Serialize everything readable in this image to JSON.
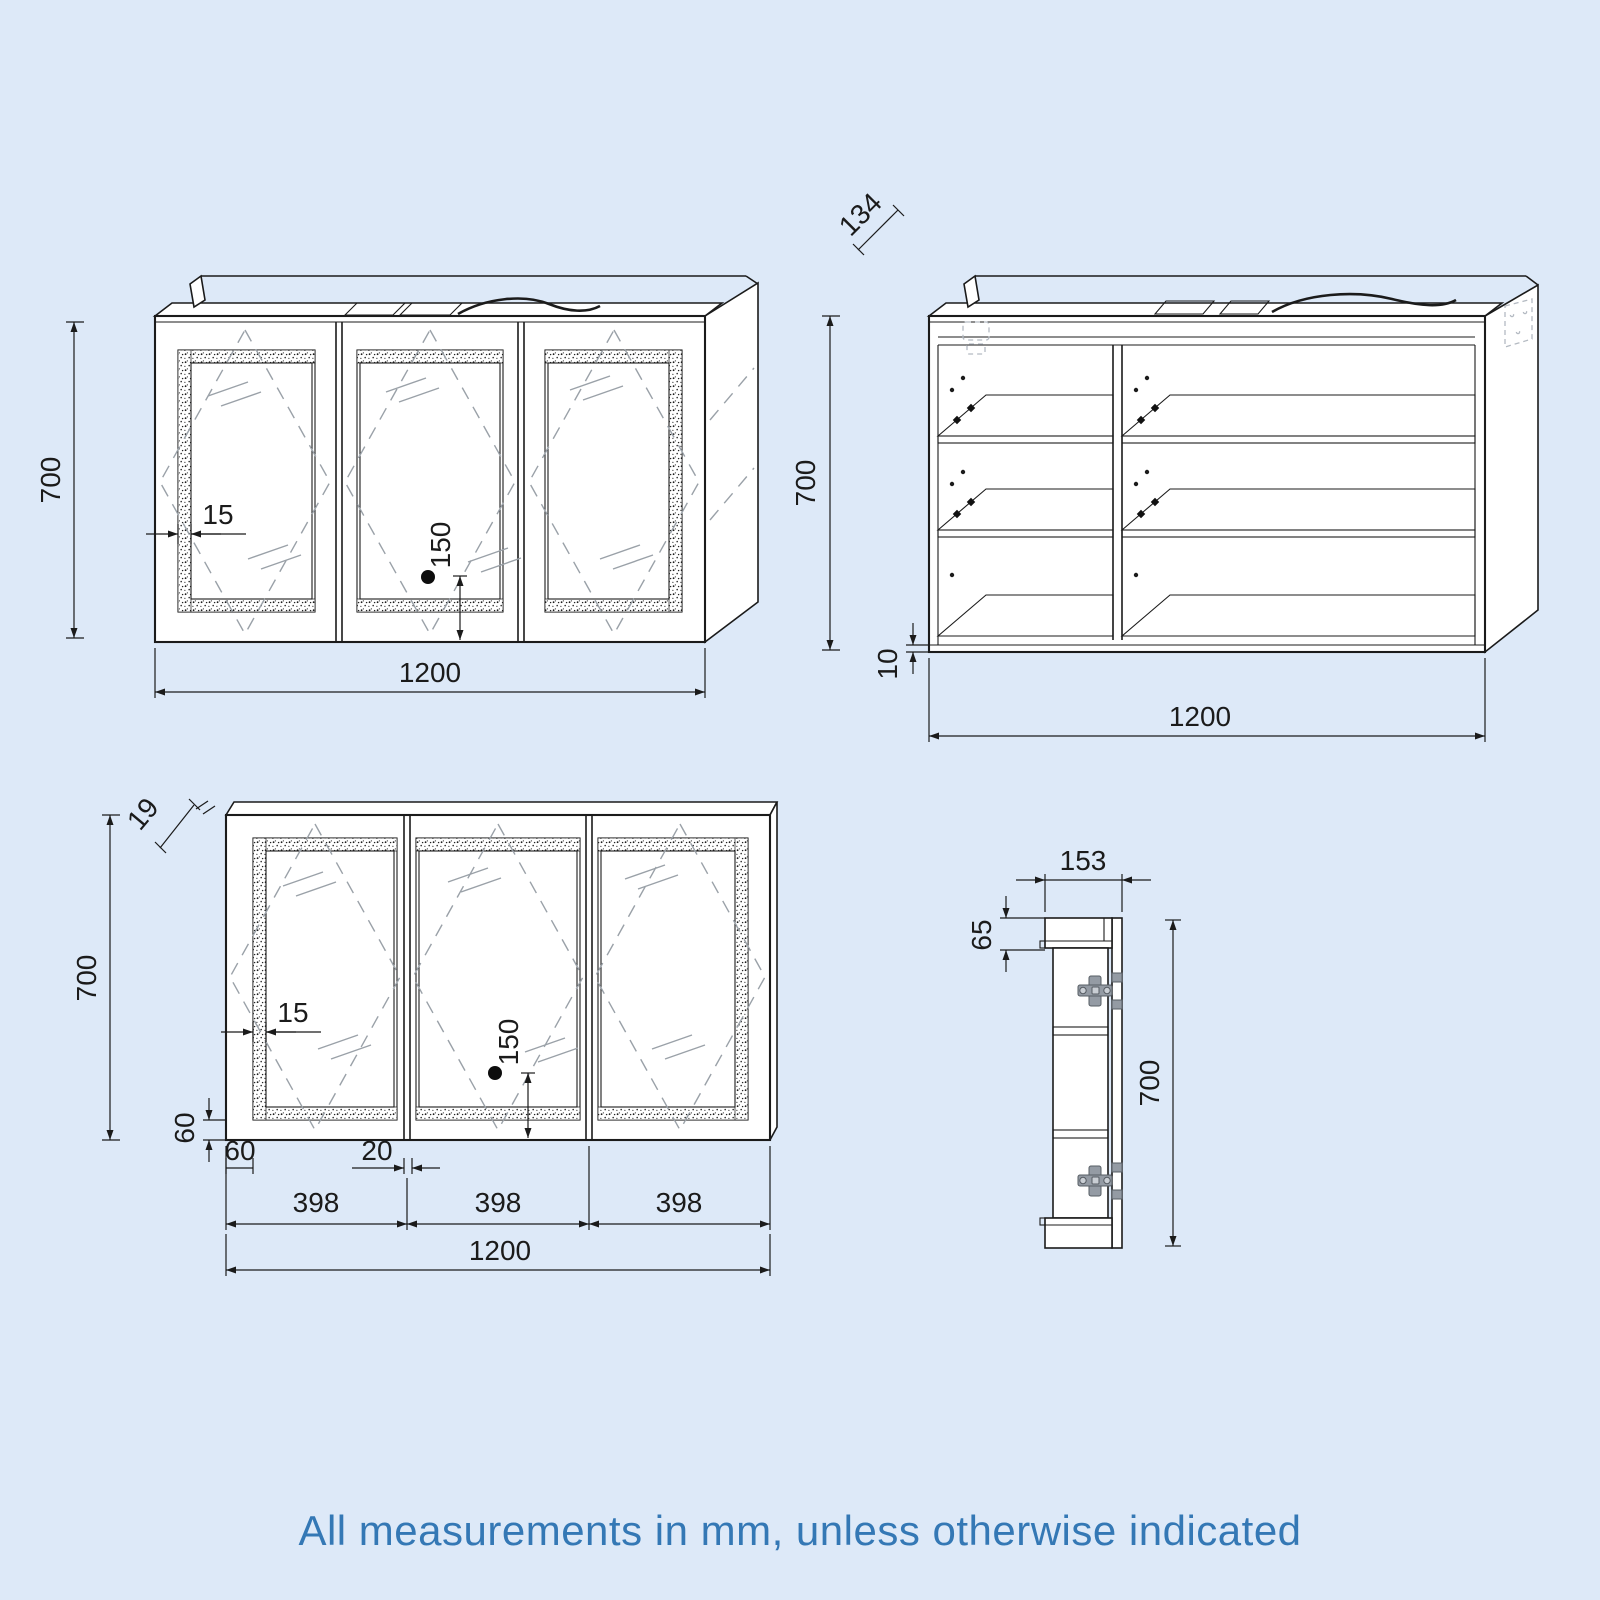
{
  "title": "Mirror cabinet technical drawing",
  "note": "All measurements in mm, unless otherwise indicated",
  "colors": {
    "background": "#dde9f8",
    "line": "#1b1b1b",
    "hatch": "#9aa1a8",
    "hinge": "#949ba4",
    "note_text": "#3478b5"
  },
  "views": {
    "front_perspective": {
      "dims": {
        "height": "700",
        "width": "1200",
        "frame_inset": "15",
        "sensor_offset": "150"
      }
    },
    "internal": {
      "dims": {
        "top_depth": "134",
        "height": "700",
        "bottom_thickness": "10",
        "width": "1200"
      }
    },
    "front_flat": {
      "dims": {
        "door_thickness": "19",
        "height": "700",
        "frame_inset": "15",
        "sensor_offset": "150",
        "mirror_bottom_margin": "60",
        "mirror_side_margin": "60",
        "mirror_gap": "20",
        "door_width_a": "398",
        "door_width_b": "398",
        "door_width_c": "398",
        "width": "1200"
      }
    },
    "side": {
      "dims": {
        "depth": "153",
        "top_section": "65",
        "height": "700"
      }
    }
  }
}
